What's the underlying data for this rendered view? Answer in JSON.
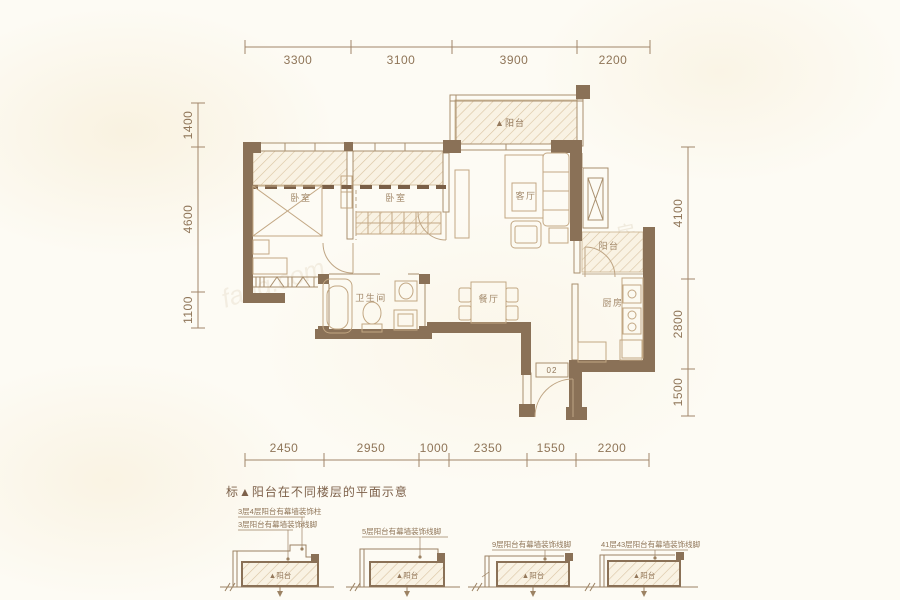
{
  "plan": {
    "rooms": {
      "bedroom_left": "卧室",
      "bedroom_mid": "卧室",
      "living": "客厅",
      "dining": "餐厅",
      "bathroom": "卫生间",
      "kitchen": "厨房",
      "balcony_top": "▲阳台",
      "balcony_right": "阳台",
      "unit_number": "02"
    },
    "dims": {
      "top": [
        "3300",
        "3100",
        "3900",
        "2200"
      ],
      "bottom": [
        "2450",
        "2950",
        "1000",
        "2350",
        "1550",
        "2200"
      ],
      "left": [
        "1400",
        "4600",
        "1100"
      ],
      "right": [
        "4100",
        "2800",
        "1500"
      ]
    }
  },
  "legend": {
    "title": "标▲阳台在不同楼层的平面示意",
    "items": [
      {
        "label1": "3层4层阳台有幕墙装饰柱",
        "label2": "3层阳台有幕墙装饰线脚",
        "balcony": "▲阳台"
      },
      {
        "label1": "5层阳台有幕墙装饰线脚",
        "balcony": "▲阳台"
      },
      {
        "label1": "9层阳台有幕墙装饰线脚",
        "balcony": "▲阳台"
      },
      {
        "label1": "41层43层阳台有幕墙装饰线脚",
        "balcony": "▲阳台"
      }
    ]
  },
  "watermark": {
    "site": "fang.com",
    "char": "房"
  },
  "colors": {
    "wall": "#8a7157",
    "line": "#a98f6e",
    "hatch": "#d9c3a1",
    "text": "#8f7558",
    "background": "#fdfbf4"
  }
}
